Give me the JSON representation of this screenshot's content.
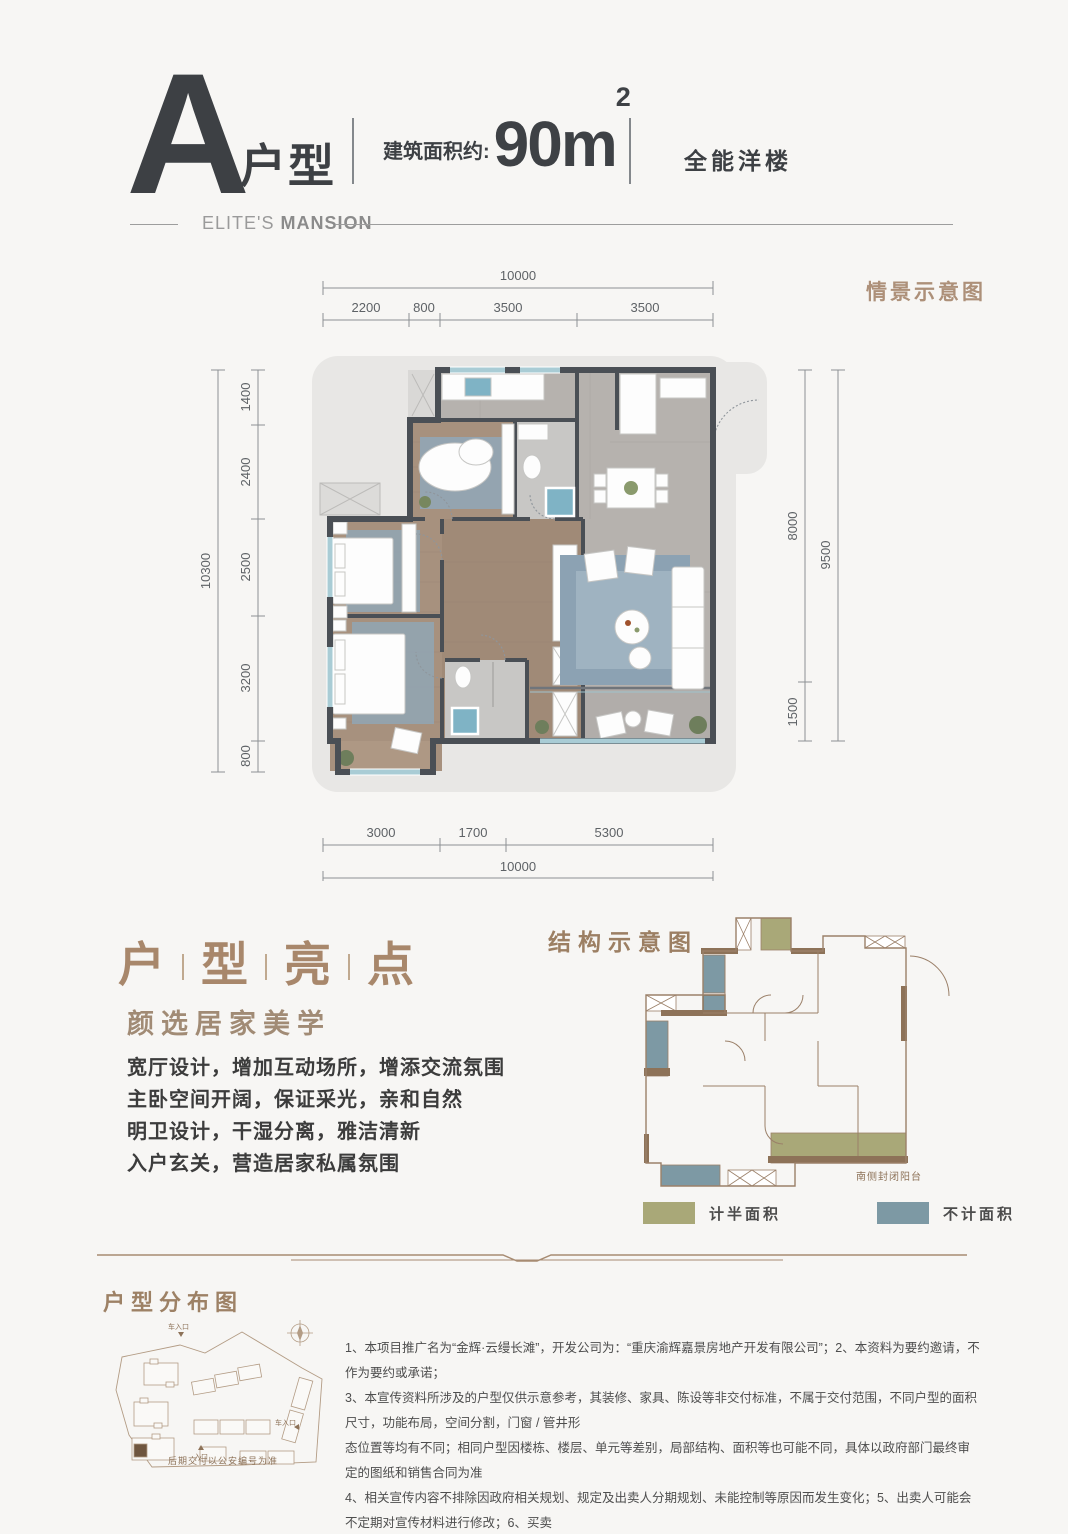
{
  "header": {
    "letter": "A",
    "unit_label": "户型",
    "area_prefix": "建筑面积约:",
    "area_value": "90m",
    "area_sup": "2",
    "tagline": "全能洋楼",
    "brand_light": "ELITE'S ",
    "brand_bold": "MANSION"
  },
  "plan": {
    "scene_label": "情景示意图",
    "dims_top_total": "10000",
    "dims_top": [
      "2200",
      "800",
      "3500",
      "3500"
    ],
    "dims_left_total": "10300",
    "dims_left": [
      "1400",
      "2400",
      "2500",
      "3200",
      "800"
    ],
    "dims_right": [
      "8000",
      "1500"
    ],
    "dims_right_total": "9500",
    "dims_bottom": [
      "3000",
      "1700",
      "5300"
    ],
    "dims_bottom_total": "10000"
  },
  "highlights": {
    "title_chars": [
      "户",
      "型",
      "亮",
      "点"
    ],
    "subtitle": "颜选居家美学",
    "items": [
      "宽厅设计，增加互动场所，增添交流氛围",
      "主卧空间开阔，保证采光，亲和自然",
      "明卫设计，干湿分离，雅洁清新",
      "入户玄关，营造居家私属氛围"
    ]
  },
  "structure": {
    "title": "结构示意图",
    "balcony_label": "南侧封闭阳台",
    "legend": [
      {
        "label": "计半面积",
        "color": "#a9a878"
      },
      {
        "label": "不计面积",
        "color": "#7d99a4"
      }
    ]
  },
  "distribution": {
    "title": "户型分布图",
    "caption": "后期交付以公安编号为准",
    "entry_top": "车入口",
    "entry_right": "车入口",
    "entry_bottom": "入口"
  },
  "disclaimer": {
    "lines": [
      "1、本项目推广名为“金辉·云缦长滩”，开发公司为：“重庆渝辉嘉景房地产开发有限公司”；2、本资料为要约邀请，不作为要约或承诺；",
      "3、本宣传资料所涉及的户型仅供示意参考，其装修、家具、陈设等非交付标准，不属于交付范围，不同户型的面积尺寸，功能布局，空间分割，门窗 / 管井形",
      "态位置等均有不同；相同户型因楼栋、楼层、单元等差别，局部结构、面积等也可能不同，具体以政府部门最终审定的图纸和销售合同为准",
      "4、相关宣传内容不排除因政府相关规划、规定及出卖人分期规划、未能控制等原因而发生变化；5、出卖人可能会不定期对宣传材料进行修改；6、买卖",
      "双方的权利义务以双方签订的《商品房买卖合同》及其补充协议、附件等书面文件为准；7、本资料所发布的内容为 2021 年 9 月 30 日前的信息，敬请留意最新资料。"
    ]
  }
}
